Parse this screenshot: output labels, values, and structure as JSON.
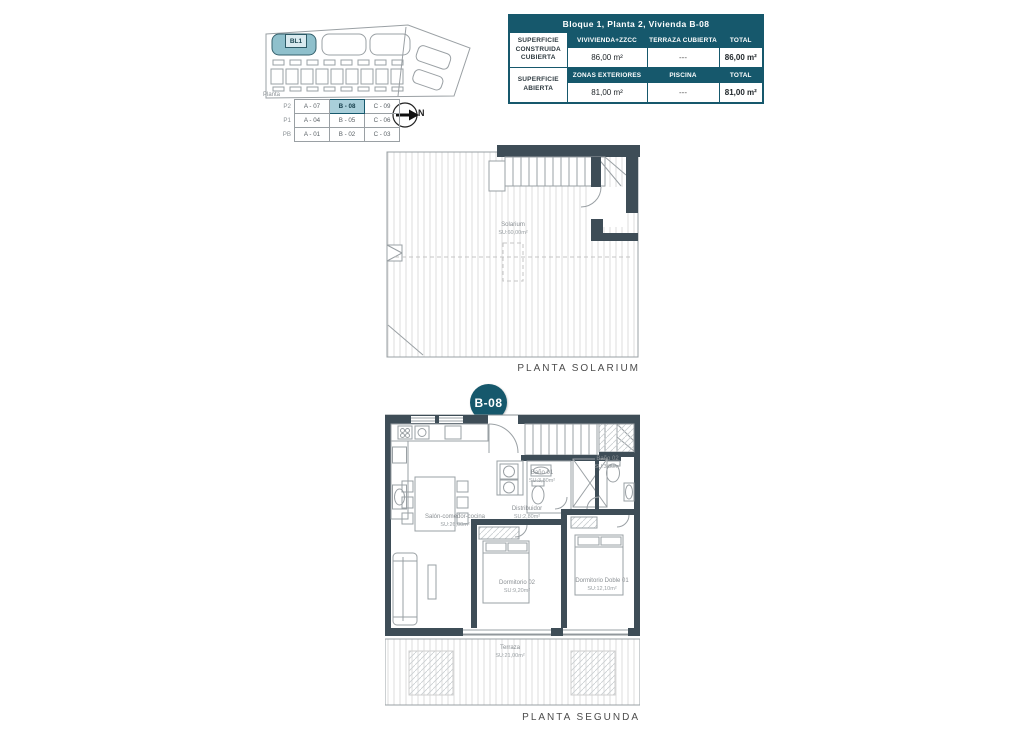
{
  "colors": {
    "teal_dark": "#16586c",
    "teal_light": "#8fc0cc",
    "wall": "#3e4d57"
  },
  "site_plan": {
    "block_label": "BL1",
    "north_label": "N",
    "legend": {
      "title": "Planta",
      "rows": [
        {
          "level": "P2",
          "a": "A - 07",
          "b": "B - 08",
          "c": "C - 09"
        },
        {
          "level": "P1",
          "a": "A - 04",
          "b": "B - 05",
          "c": "C - 06"
        },
        {
          "level": "PB",
          "a": "A - 01",
          "b": "B - 02",
          "c": "C - 03"
        }
      ]
    }
  },
  "summary_table": {
    "title": "Bloque 1, Planta 2, Vivienda B-08",
    "rows": [
      {
        "label": "SUPERFICIE CONSTRUIDA CUBIERTA",
        "headers": [
          "VIVIVIENDA+ZZCC",
          "TERRAZA CUBIERTA",
          "TOTAL"
        ],
        "values": [
          "86,00 m²",
          "---",
          "86,00 m²"
        ]
      },
      {
        "label": "SUPERFICIE ABIERTA",
        "headers": [
          "ZONAS EXTERIORES",
          "PISCINA",
          "TOTAL"
        ],
        "values": [
          "81,00 m²",
          "---",
          "81,00 m²"
        ]
      }
    ]
  },
  "solarium_plan": {
    "caption": "PLANTA SOLARIUM",
    "room": {
      "name": "Solarium",
      "area": "SU:60,00m²"
    }
  },
  "segunda_plan": {
    "caption": "PLANTA SEGUNDA",
    "pin_label": "B-08",
    "rooms": {
      "salon": {
        "name": "Salón-comedor-cocina",
        "area": "SU:26,00m²"
      },
      "distribuidor": {
        "name": "Distribuidor",
        "area": "SU:2,80m²"
      },
      "bano1": {
        "name": "Baño 01",
        "area": "SU:3,80m²"
      },
      "bano2": {
        "name": "Baño 02",
        "area": "SU:3,80m²"
      },
      "dorm2": {
        "name": "Dormitorio 02",
        "area": "SU:9,20m²"
      },
      "dorm1": {
        "name": "Dormitorio Doble 01",
        "area": "SU:12,10m²"
      },
      "terraza": {
        "name": "Terraza",
        "area": "SU:21,00m²"
      }
    }
  }
}
